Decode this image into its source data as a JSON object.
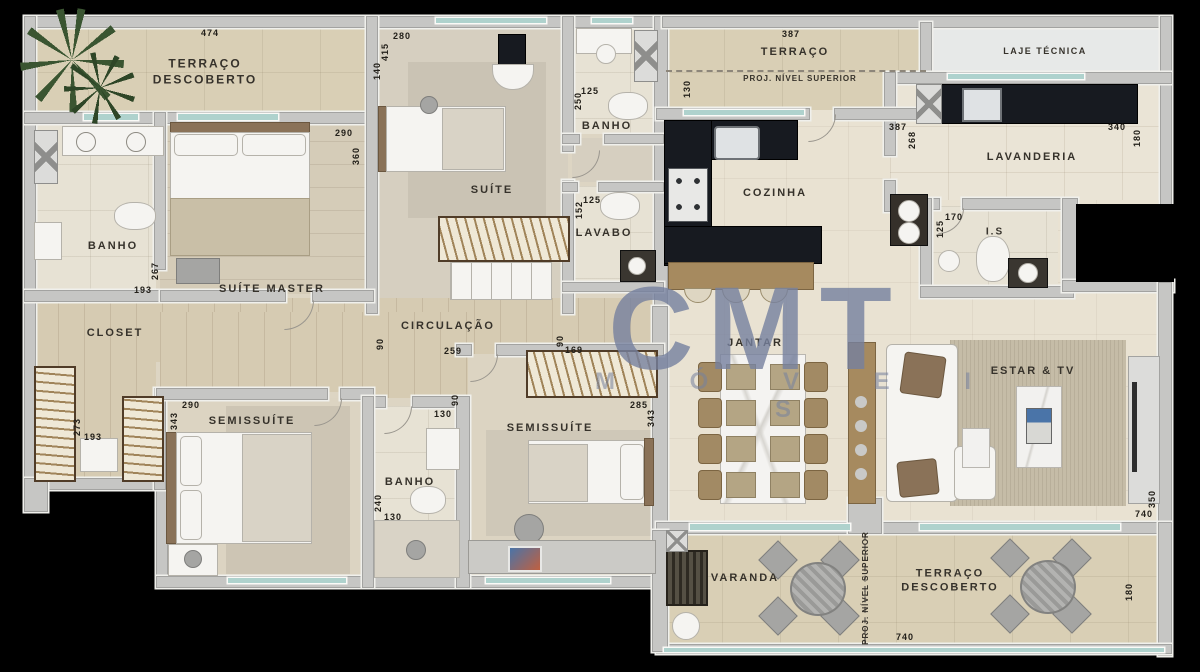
{
  "watermark": {
    "line1": "CMT",
    "line2": "M Ó V E I S",
    "color": "#76819f"
  },
  "palette": {
    "background": "#000000",
    "wall": "#c6c6c4",
    "floor_cream": "#e9e2d2",
    "floor_terrace": "#d9cfb5",
    "floor_wood": "#d6cbb2",
    "counter_dark": "#171a20",
    "island_wood": "#a68a5f",
    "window_glass": "#afd2cd",
    "label_text": "#36322b",
    "dim_text": "#23201a"
  },
  "room_labels": [
    {
      "id": "terraco-descoberto-tl",
      "lines": [
        "TERRAÇO",
        "DESCOBERTO"
      ],
      "x": 205,
      "y": 72,
      "size": 12
    },
    {
      "id": "suite",
      "text": "SUÍTE",
      "x": 492,
      "y": 190
    },
    {
      "id": "banho-suite",
      "text": "BANHO",
      "x": 607,
      "y": 126
    },
    {
      "id": "lavabo",
      "text": "LAVABO",
      "x": 604,
      "y": 233
    },
    {
      "id": "banho-master",
      "text": "BANHO",
      "x": 113,
      "y": 246
    },
    {
      "id": "suite-master",
      "text": "SUÍTE MASTER",
      "x": 272,
      "y": 289
    },
    {
      "id": "closet",
      "text": "CLOSET",
      "x": 115,
      "y": 333
    },
    {
      "id": "circulacao",
      "text": "CIRCULAÇÃO",
      "x": 448,
      "y": 326
    },
    {
      "id": "semissuite-1",
      "text": "SEMISSUÍTE",
      "x": 252,
      "y": 421
    },
    {
      "id": "banho-semissuite-1",
      "text": "BANHO",
      "x": 410,
      "y": 482
    },
    {
      "id": "semissuite-2",
      "text": "SEMISSUÍTE",
      "x": 550,
      "y": 428
    },
    {
      "id": "terraco-tr",
      "text": "TERRAÇO",
      "x": 795,
      "y": 52
    },
    {
      "id": "proj-nivel-superior-top",
      "text": "PROJ. NÍVEL SUPERIOR",
      "x": 800,
      "y": 79,
      "size": 8,
      "ls": 1
    },
    {
      "id": "laje-tecnica",
      "text": "LAJE TÉCNICA",
      "x": 1045,
      "y": 52,
      "size": 9,
      "ls": 1.5
    },
    {
      "id": "cozinha",
      "text": "COZINHA",
      "x": 775,
      "y": 193
    },
    {
      "id": "lavanderia",
      "text": "LAVANDERIA",
      "x": 1032,
      "y": 157
    },
    {
      "id": "is",
      "text": "I.S",
      "x": 995,
      "y": 232,
      "size": 10
    },
    {
      "id": "jantar",
      "text": "JANTAR",
      "x": 755,
      "y": 343
    },
    {
      "id": "estar-tv",
      "text": "ESTAR & TV",
      "x": 1033,
      "y": 371
    },
    {
      "id": "varanda",
      "text": "VARANDA",
      "x": 745,
      "y": 578
    },
    {
      "id": "terraco-descoberto-br",
      "lines": [
        "TERRAÇO",
        "DESCOBERTO"
      ],
      "x": 950,
      "y": 581,
      "size": 11
    },
    {
      "id": "proj-nivel-superior-vert",
      "text": "PROJ. NÍVEL SUPERIOR",
      "x": 866,
      "y": 588,
      "size": 8,
      "ls": 1,
      "rot": -90
    }
  ],
  "dimension_labels": [
    {
      "text": "474",
      "x": 210,
      "y": 33
    },
    {
      "text": "280",
      "x": 402,
      "y": 36
    },
    {
      "text": "415",
      "x": 385,
      "y": 52,
      "rot": -90
    },
    {
      "text": "140",
      "x": 377,
      "y": 71,
      "rot": -90
    },
    {
      "text": "290",
      "x": 344,
      "y": 133
    },
    {
      "text": "360",
      "x": 356,
      "y": 156,
      "rot": -90
    },
    {
      "text": "125",
      "x": 590,
      "y": 91
    },
    {
      "text": "250",
      "x": 578,
      "y": 101,
      "rot": -90
    },
    {
      "text": "125",
      "x": 592,
      "y": 200
    },
    {
      "text": "152",
      "x": 579,
      "y": 210,
      "rot": -90
    },
    {
      "text": "267",
      "x": 155,
      "y": 271,
      "rot": -90
    },
    {
      "text": "193",
      "x": 143,
      "y": 290
    },
    {
      "text": "273",
      "x": 77,
      "y": 427,
      "rot": -90
    },
    {
      "text": "193",
      "x": 93,
      "y": 437
    },
    {
      "text": "290",
      "x": 191,
      "y": 405
    },
    {
      "text": "343",
      "x": 174,
      "y": 421,
      "rot": -90
    },
    {
      "text": "90",
      "x": 380,
      "y": 344,
      "rot": -90
    },
    {
      "text": "259",
      "x": 453,
      "y": 351
    },
    {
      "text": "90",
      "x": 560,
      "y": 341,
      "rot": -90
    },
    {
      "text": "169",
      "x": 574,
      "y": 350
    },
    {
      "text": "90",
      "x": 455,
      "y": 400,
      "rot": -90
    },
    {
      "text": "130",
      "x": 443,
      "y": 414
    },
    {
      "text": "240",
      "x": 378,
      "y": 503,
      "rot": -90
    },
    {
      "text": "130",
      "x": 393,
      "y": 517
    },
    {
      "text": "285",
      "x": 639,
      "y": 405
    },
    {
      "text": "343",
      "x": 651,
      "y": 418,
      "rot": -90
    },
    {
      "text": "387",
      "x": 791,
      "y": 34
    },
    {
      "text": "130",
      "x": 687,
      "y": 89,
      "rot": -90
    },
    {
      "text": "387",
      "x": 898,
      "y": 127
    },
    {
      "text": "268",
      "x": 912,
      "y": 140,
      "rot": -90
    },
    {
      "text": "340",
      "x": 1117,
      "y": 127
    },
    {
      "text": "180",
      "x": 1137,
      "y": 138,
      "rot": -90
    },
    {
      "text": "170",
      "x": 954,
      "y": 217
    },
    {
      "text": "125",
      "x": 940,
      "y": 229,
      "rot": -90
    },
    {
      "text": "350",
      "x": 1152,
      "y": 499,
      "rot": -90
    },
    {
      "text": "740",
      "x": 1144,
      "y": 514
    },
    {
      "text": "180",
      "x": 1129,
      "y": 592,
      "rot": -90
    },
    {
      "text": "740",
      "x": 905,
      "y": 637
    }
  ]
}
